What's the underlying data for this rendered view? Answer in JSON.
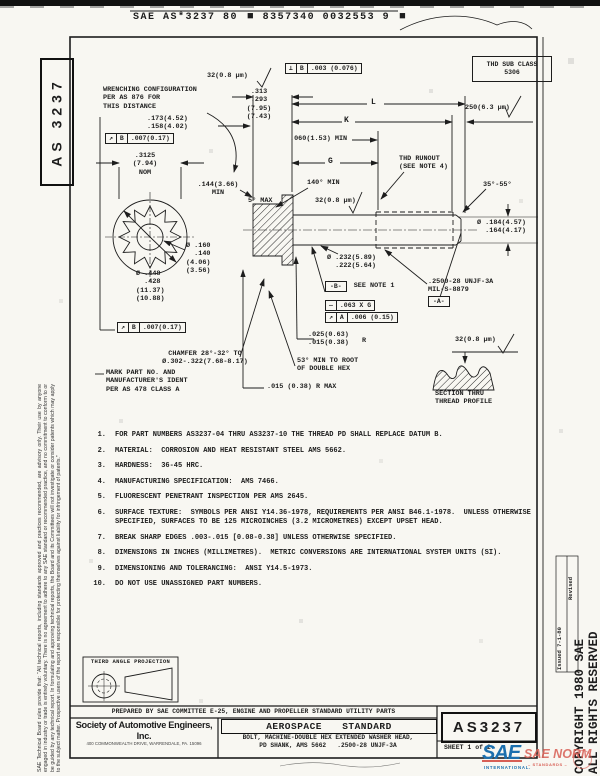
{
  "header": {
    "part1": "SAE AS*3237 80",
    "part2": "8357340 0032553 9"
  },
  "icons": {
    "block": "■",
    "surface_check": "√"
  },
  "margins": {
    "doc_number_vertical": "AS 3237",
    "disclaimer": "SAE Technical Board rules provide that: “All technical reports, including standards approved and practices recommended, are advisory only. Their use by anyone engaged in industry or trade is entirely voluntary. There is no agreement to adhere to any SAE standard or recommended practice, and no commitment to conform to or be guided by any technical report. In formulating and approving technical reports, the Board and its Committees will not investigate or consider patents which may apply to the subject matter. Prospective users of the report are responsible for protecting themselves against liability for infringement of patents.”",
    "copyright_line1": "COPYRIGHT 1980 SAE",
    "copyright_line2": "ALL RIGHTS RESERVED",
    "issued": "Issued 7-1-80",
    "revised": "Revised"
  },
  "drawing": {
    "callouts": {
      "wrenching": "WRENCHING CONFIGURATION\nPER AS 876 FOR\nTHIS DISTANCE",
      "dim_wrench_depth": ".173(4.52)\n.158(4.02)",
      "dim_across_flats": ".3125\n(7.94)\nNOM",
      "dim_head_height": ".313\n.293\n(7.95)\n(7.43)",
      "sf_32": "32(0.8 μm)",
      "sf_250": "250(6.3 μm)",
      "thd_sub_class": "THD SUB CLASS\n5306",
      "dim_L": "L",
      "dim_K": "K",
      "dim_G": "G",
      "dim_runout_min": ".060(1.53) MIN",
      "thd_runout": "THD RUNOUT\n(SEE NOTE 4)",
      "angle_point": "35°-55°",
      "dim_point_dia": "Ø .184(4.57)\n  .164(4.17)",
      "dim_wrench_min": ".144(3.66)\nMIN",
      "angle_draft": "5° MAX",
      "angle_csk": "140° MIN",
      "dim_bore": "Ø .160\n  .140\n(4.06)\n(3.56)",
      "dim_head_dia": "Ø .448\n  .428\n(11.37)\n(10.88)",
      "dim_shank_dia": "Ø .232(5.89)\n  .222(5.64)",
      "datum_b": "-B-",
      "see_note_1": "SEE NOTE 1",
      "fcf_straight": {
        "sym": "—",
        "val": ".063 X G"
      },
      "fcf_a": {
        "sym": "↗",
        "datum": "A",
        "val": ".006 (0.15)"
      },
      "fcf_b_top": {
        "sym": "↗",
        "datum": "B",
        "val": ".007(0.17)"
      },
      "fcf_b_bottom": {
        "sym": "↗",
        "datum": "B",
        "val": ".007(0.17)"
      },
      "fcf_perp": {
        "sym": "⊥",
        "datum": "B",
        "val": ".003 (0.076)"
      },
      "thread_spec": ".2500-28 UNJF-3A\nMIL-S-8879",
      "datum_a": "-A-",
      "dim_fillet": ".025(0.63)\n.015(0.38)",
      "fillet_r": "R",
      "chamfer": "CHAMFER 28°-32° TO\nØ.302-.322(7.68-8.17)",
      "mark": "MARK PART NO. AND\nMANUFACTURER'S IDENT\nPER AS 478 CLASS A",
      "angle_hex_root": "53° MIN TO ROOT\nOF DOUBLE HEX",
      "dim_r_max": ".015 (0.38) R MAX",
      "section": "SECTION THRU\nTHREAD PROFILE"
    },
    "notes": [
      {
        "num": "1.",
        "text": "FOR PART NUMBERS AS3237-04 THRU AS3237-10 THE THREAD PD SHALL REPLACE DATUM B."
      },
      {
        "num": "2.",
        "text": "MATERIAL:  CORROSION AND HEAT RESISTANT STEEL AMS 5662."
      },
      {
        "num": "3.",
        "text": "HARDNESS:  36-45 HRC."
      },
      {
        "num": "4.",
        "text": "MANUFACTURING SPECIFICATION:  AMS 7466."
      },
      {
        "num": "5.",
        "text": "FLUORESCENT PENETRANT INSPECTION PER AMS 2645."
      },
      {
        "num": "6.",
        "text": "SURFACE TEXTURE:  SYMBOLS PER ANSI Y14.36-1978, REQUIREMENTS PER ANSI B46.1-1978.  UNLESS OTHERWISE\nSPECIFIED, SURFACES TO BE 125 MICROINCHES (3.2 MICROMETRES) EXCEPT UPSET HEAD."
      },
      {
        "num": "7.",
        "text": "BREAK SHARP EDGES .003-.015 [0.08-0.38] UNLESS OTHERWISE SPECIFIED."
      },
      {
        "num": "8.",
        "text": "DIMENSIONS IN INCHES (MILLIMETRES).  METRIC CONVERSIONS ARE INTERNATIONAL SYSTEM UNITS (SI)."
      },
      {
        "num": "9.",
        "text": "DIMENSIONING AND TOLERANCING:  ANSI Y14.5-1973."
      },
      {
        "num": "10.",
        "text": "DO NOT USE UNASSIGNED PART NUMBERS."
      }
    ]
  },
  "footer": {
    "projection": "THIRD ANGLE PROJECTION",
    "prepared_by": "PREPARED BY SAE COMMITTEE E-25, ENGINE AND PROPELLER STANDARD UTILITY PARTS",
    "org": "Society of Automotive Engineers, Inc.",
    "org_address": "400 COMMONWEALTH DRIVE, WARRENDALE, PA. 15096",
    "doc_type": "AEROSPACE STANDARD",
    "title_line1": "BOLT, MACHINE-DOUBLE HEX EXTENDED WASHER HEAD,",
    "title_line2": "PD SHANK, AMS 5662   .2500-28 UNJF-3A",
    "doc_number": "AS3237",
    "sheet": "SHEET 1 of 2"
  },
  "logo": {
    "sae": "SAE",
    "norm": "SAE NORM",
    "intl": "INTERNATIONAL.",
    "sub": "– STANDARDS –",
    "blue": "#1b6fae",
    "red": "#d85f55"
  }
}
